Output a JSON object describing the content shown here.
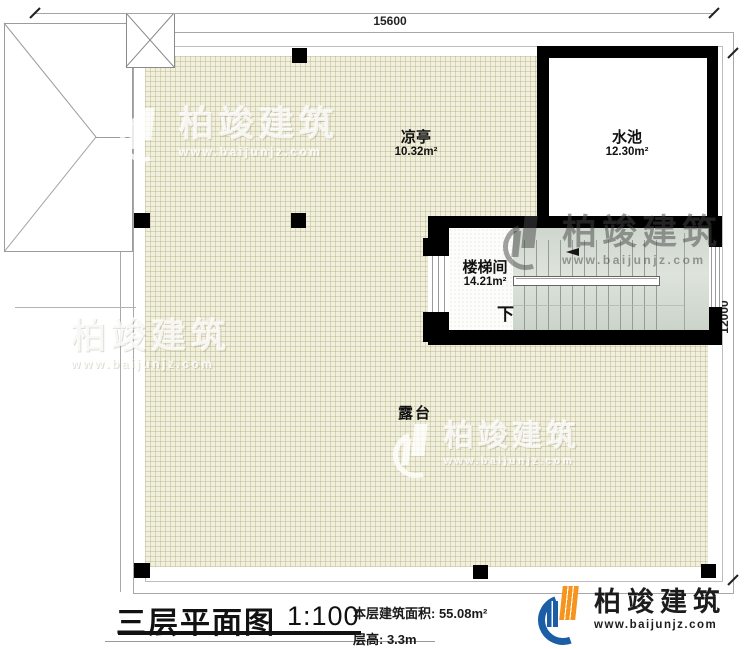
{
  "plan": {
    "dimensions": {
      "width_mm": "15600",
      "height_mm": "12000"
    },
    "rooms": {
      "pavilion": {
        "label": "凉亭",
        "area": "10.32m²"
      },
      "pool": {
        "label": "水池",
        "area": "12.30m²"
      },
      "stairwell": {
        "label": "楼梯间",
        "area": "14.21m²",
        "direction": "下"
      },
      "terrace": {
        "label": "露台"
      }
    }
  },
  "title_block": {
    "title": "三层平面图",
    "scale": "1:100",
    "floor_area": "本层建筑面积: 55.08m²",
    "floor_height": "层高: 3.3m"
  },
  "brand": {
    "name": "柏竣建筑",
    "url": "www.baijunjz.com"
  },
  "watermark": {
    "name": "柏竣建筑",
    "url": "www.baijunjz.com"
  },
  "colors": {
    "wall": "#000000",
    "hatch_fill": "#f1efde",
    "stair_fill": "#d9e0d7",
    "logo_blue": "#1b5ea6",
    "logo_orange": "#f7941d"
  }
}
